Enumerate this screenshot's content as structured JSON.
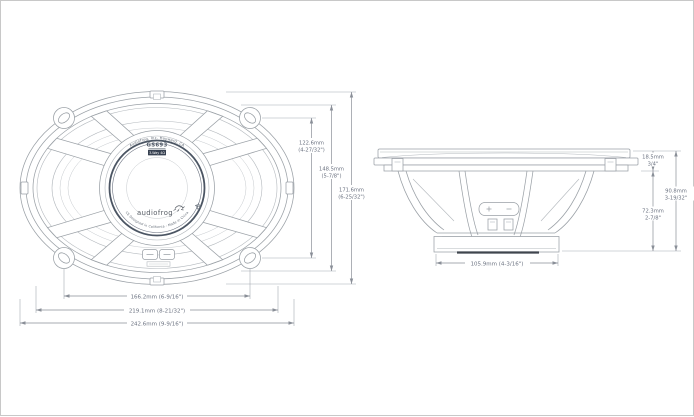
{
  "drawing_title": "GS693 speaker dimension drawing",
  "front_view": {
    "hub": {
      "maker_arc": "Audiofrog, Inc. Hayward, CA",
      "model": "GS693",
      "badge": "3-Way 4Ω",
      "brand": "audiofrog",
      "origin_arc": "CE   Designed in California  -  Made in China"
    },
    "dims": {
      "screw_v_mm": "122.6mm",
      "screw_v_in": "(4-27/32\")",
      "cutout_v_mm": "148.5mm",
      "cutout_v_in": "(5-7/8\")",
      "overall_v_mm": "171.6mm",
      "overall_v_in": "(6-25/32\")",
      "screw_h": "166.2mm (6-9/16\")",
      "cutout_h": "219.1mm (8-21/32\")",
      "overall_h": "242.6mm (9-9/16\")"
    }
  },
  "side_view": {
    "dims": {
      "protrusion_mm": "18.5mm",
      "protrusion_in": "3/4\"",
      "overall_depth_mm": "90.8mm",
      "overall_depth_in": "3-19/32\"",
      "mounting_depth_mm": "72.3mm",
      "mounting_depth_in": "2-7/8\"",
      "magnet_w": "105.9mm (4-3/16\")"
    }
  },
  "colors": {
    "linework": "#9aa0a6",
    "dimension_text": "#6b7280",
    "badge_fill": "#374151"
  }
}
